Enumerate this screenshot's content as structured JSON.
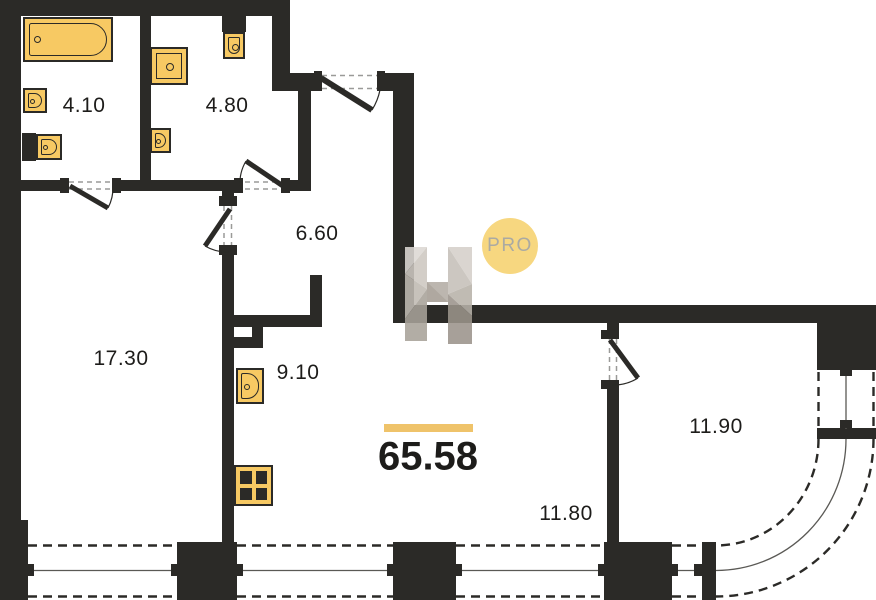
{
  "plan": {
    "type": "apartment-floor-plan",
    "total": {
      "area": "65.58"
    },
    "watermark": {
      "badge": "PRO"
    },
    "rooms": [
      {
        "name": "bathroom",
        "area": "4.10"
      },
      {
        "name": "shower-wc-room",
        "area": "4.80"
      },
      {
        "name": "hallway",
        "area": "6.60"
      },
      {
        "name": "living-room",
        "area": "17.30"
      },
      {
        "name": "kitchen",
        "area": "9.10"
      },
      {
        "name": "living-dining",
        "area": "11.80"
      },
      {
        "name": "bedroom",
        "area": "11.90"
      }
    ],
    "fixtures": [
      "bathtub",
      "wall-sink",
      "toilet",
      "shower-cabin",
      "wash-basin",
      "kitchen-sink",
      "stove-4-burner"
    ],
    "colors": {
      "wall": "#2b2a27",
      "fixture_fill": "#F7C963",
      "fixture_border": "#2b2a27",
      "accent_bar": "#EFC36A",
      "badge_bg": "#F7D780",
      "badge_text": "#ABAAA2",
      "text": "#1d1c1a"
    }
  }
}
